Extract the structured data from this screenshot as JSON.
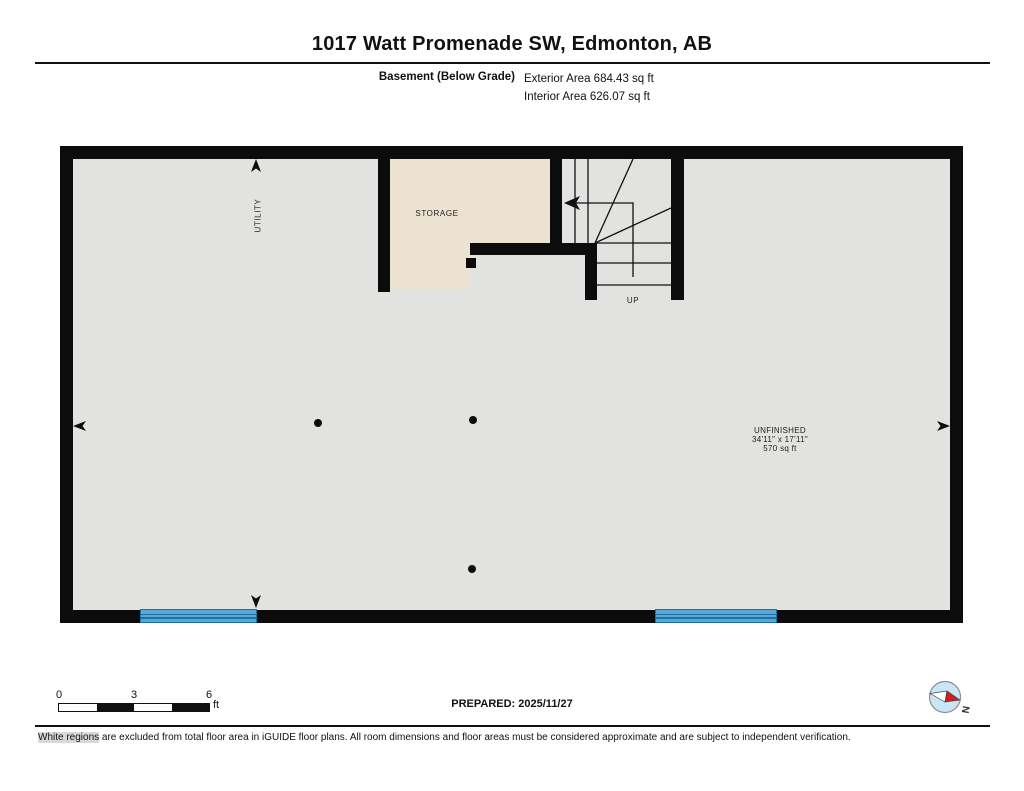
{
  "header": {
    "title": "1017 Watt Promenade SW, Edmonton, AB",
    "floor_label": "Basement (Below Grade)",
    "exterior_area": "Exterior Area 684.43 sq ft",
    "interior_area": "Interior Area 626.07 sq ft"
  },
  "plan": {
    "rooms": {
      "utility": "UTILITY",
      "storage": "STORAGE",
      "stairs_direction": "UP",
      "unfinished": {
        "name": "UNFINISHED",
        "dimensions": "34'11\" x 17'11\"",
        "area": "570 sq ft"
      }
    }
  },
  "footer": {
    "scale": {
      "ticks": [
        "0",
        "3",
        "6"
      ],
      "unit": "ft"
    },
    "prepared": "PREPARED: 2025/11/27",
    "compass_label": "N",
    "disclaimer_lead": "White regions",
    "disclaimer_rest": " are excluded from total floor area in iGUIDE floor plans. All room dimensions and floor areas must be considered approximate and are subject to independent verification."
  },
  "colors": {
    "wall": "#0c0c0c",
    "interior_floor": "#e2e2e1",
    "excluded_region": "#ece2d1",
    "window_fill": "#57a7d7",
    "window_line": "#1d6f9f",
    "compass_face": "#c9e6f6",
    "compass_north": "#cc2020"
  }
}
